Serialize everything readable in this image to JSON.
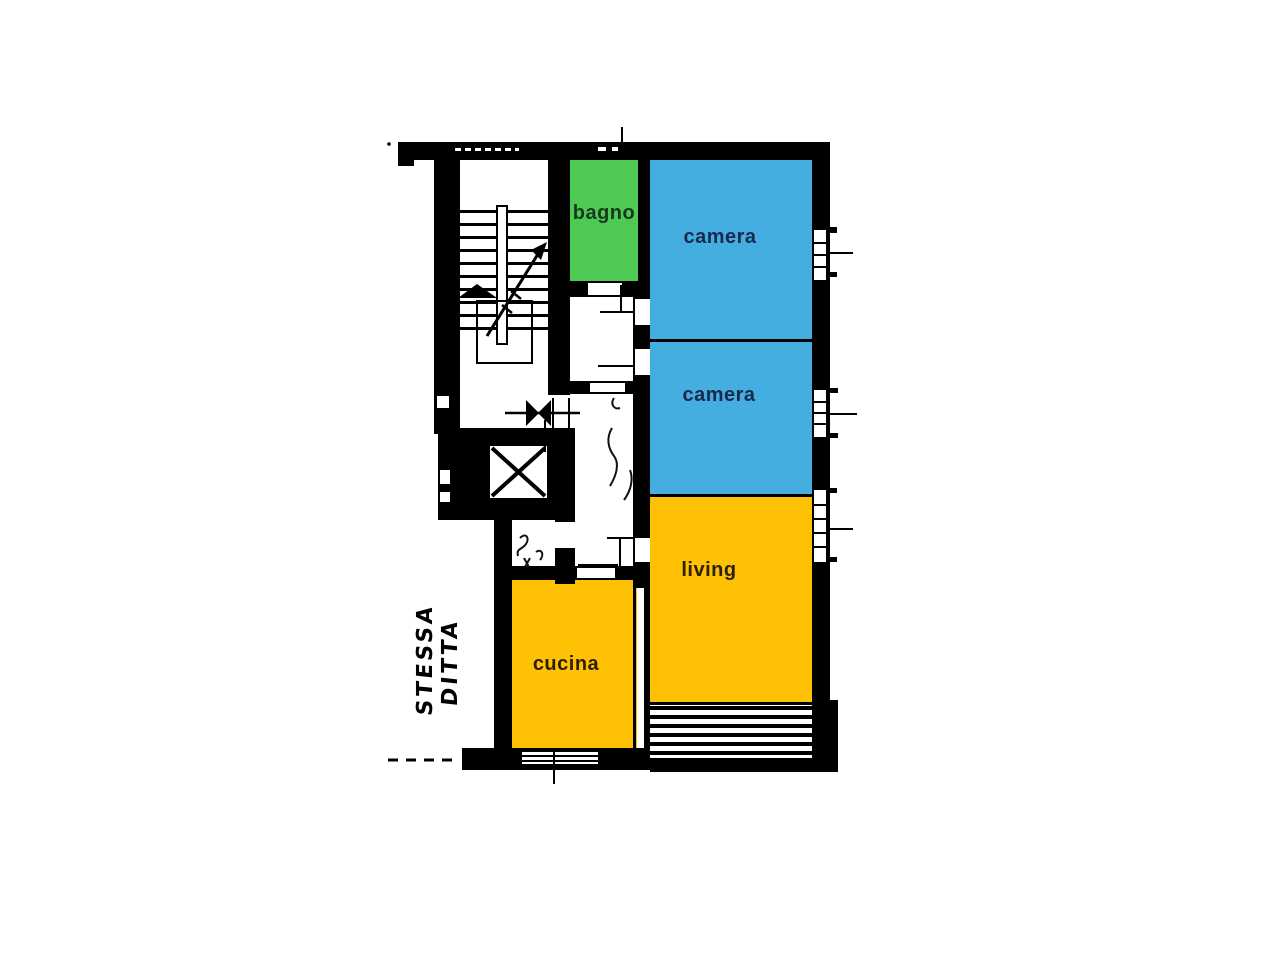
{
  "page": {
    "background": "#ffffff"
  },
  "plan": {
    "type": "apartment-floor-plan",
    "wall_color": "#000000",
    "rooms": [
      {
        "id": "bagno",
        "label": "bagno",
        "fill": "#4ec954",
        "label_color": "#163a1e"
      },
      {
        "id": "camera1",
        "label": "camera",
        "fill": "#45aee0",
        "label_color": "#162a50"
      },
      {
        "id": "camera2",
        "label": "camera",
        "fill": "#45aee0",
        "label_color": "#162a50"
      },
      {
        "id": "living",
        "label": "living",
        "fill": "#ffc103",
        "label_color": "#2d1f03"
      },
      {
        "id": "cucina",
        "label": "cucina",
        "fill": "#ffc103",
        "label_color": "#2d1f03"
      }
    ],
    "handwritten_note": "STESSA DITTA",
    "features": [
      "staircase",
      "elevator",
      "balcony",
      "windows",
      "door-openings"
    ]
  }
}
